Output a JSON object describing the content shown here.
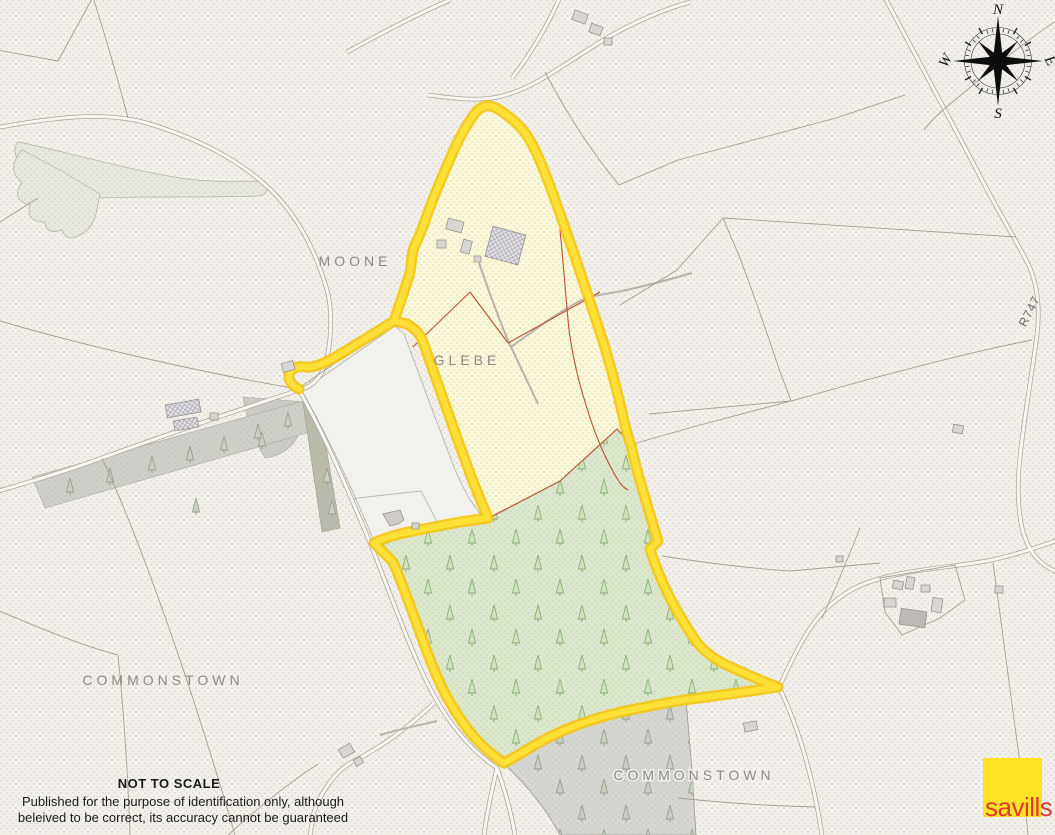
{
  "map": {
    "labels": {
      "moone": "MOONE",
      "glebe": "GLEBE",
      "commonstown_west": "COMMONSTOWN",
      "commonstown_south": "COMMONSTOWN",
      "road": "R747"
    },
    "colors": {
      "boundary_yellow": "#F5C713",
      "boundary_yellow_core": "#FFE23A",
      "glebe_field": "#FBF8D8",
      "forest_green": "#DCE8CC",
      "forest_gray": "#D5D5D2",
      "background": "#F2F0EA"
    }
  },
  "compass": {
    "north": "N",
    "south": "S",
    "east": "E",
    "west": "W"
  },
  "footer": {
    "scale_note": "NOT TO SCALE",
    "disclaimer_line1": "Published for the purpose of identification only, although",
    "disclaimer_line2": "beleived to be correct, its accuracy cannot be guaranteed"
  },
  "logo": {
    "text": "savills"
  }
}
